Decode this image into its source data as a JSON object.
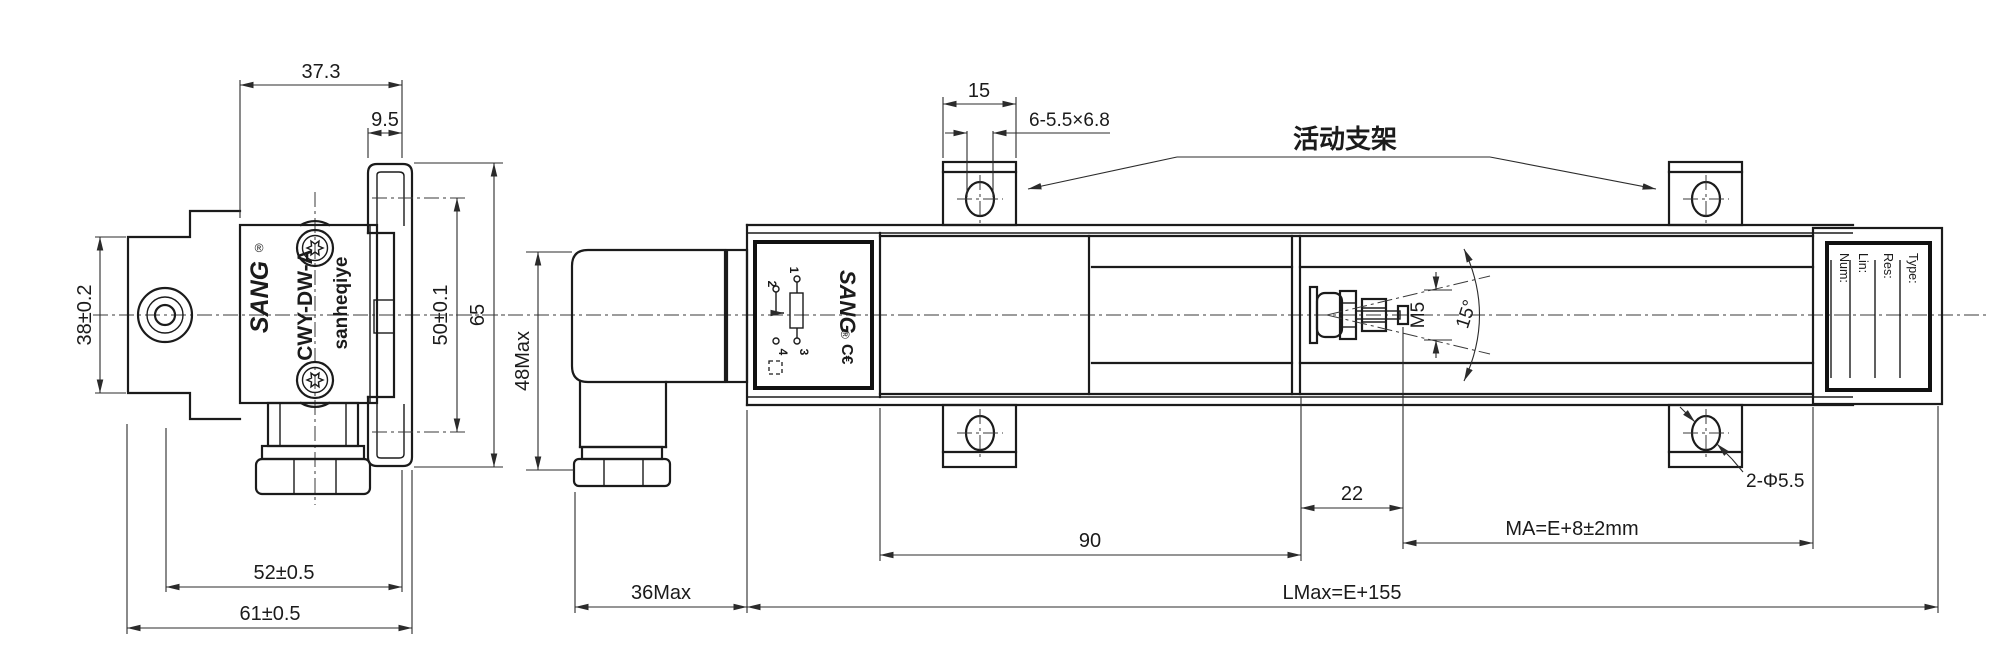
{
  "left_view": {
    "brand": "SANG",
    "reg_mark": "®",
    "model": "CWY-DW-A",
    "company": "sanheqiye",
    "dims": {
      "top_width": "37.3",
      "clip_width": "9.5",
      "flange_height": "38±0.2",
      "clip_centers": "50±0.1",
      "overall_height": "65",
      "axis_to_clip": "52±0.5",
      "overall_width": "61±0.5"
    }
  },
  "right_view": {
    "callout_bracket": "活动支架",
    "dims": {
      "bracket_width": "15",
      "slots": "6-5.5×6.8",
      "connector_height": "48Max",
      "connector_depth": "36Max",
      "body_length": "90",
      "rod_extension": "22",
      "mounting": "MA=E+8±2mm",
      "total_length": "LMax=E+155",
      "holes": "2-Φ5.5",
      "thread": "M5",
      "swivel_angle": "15°"
    },
    "label": {
      "brand": "SANG",
      "reg_mark": "®",
      "ce_mark": "C€",
      "pins": [
        "1",
        "2",
        "3",
        "4"
      ]
    },
    "nameplate": {
      "fields": [
        "Type:",
        "Res:",
        "Lin:",
        "Num:"
      ]
    }
  }
}
